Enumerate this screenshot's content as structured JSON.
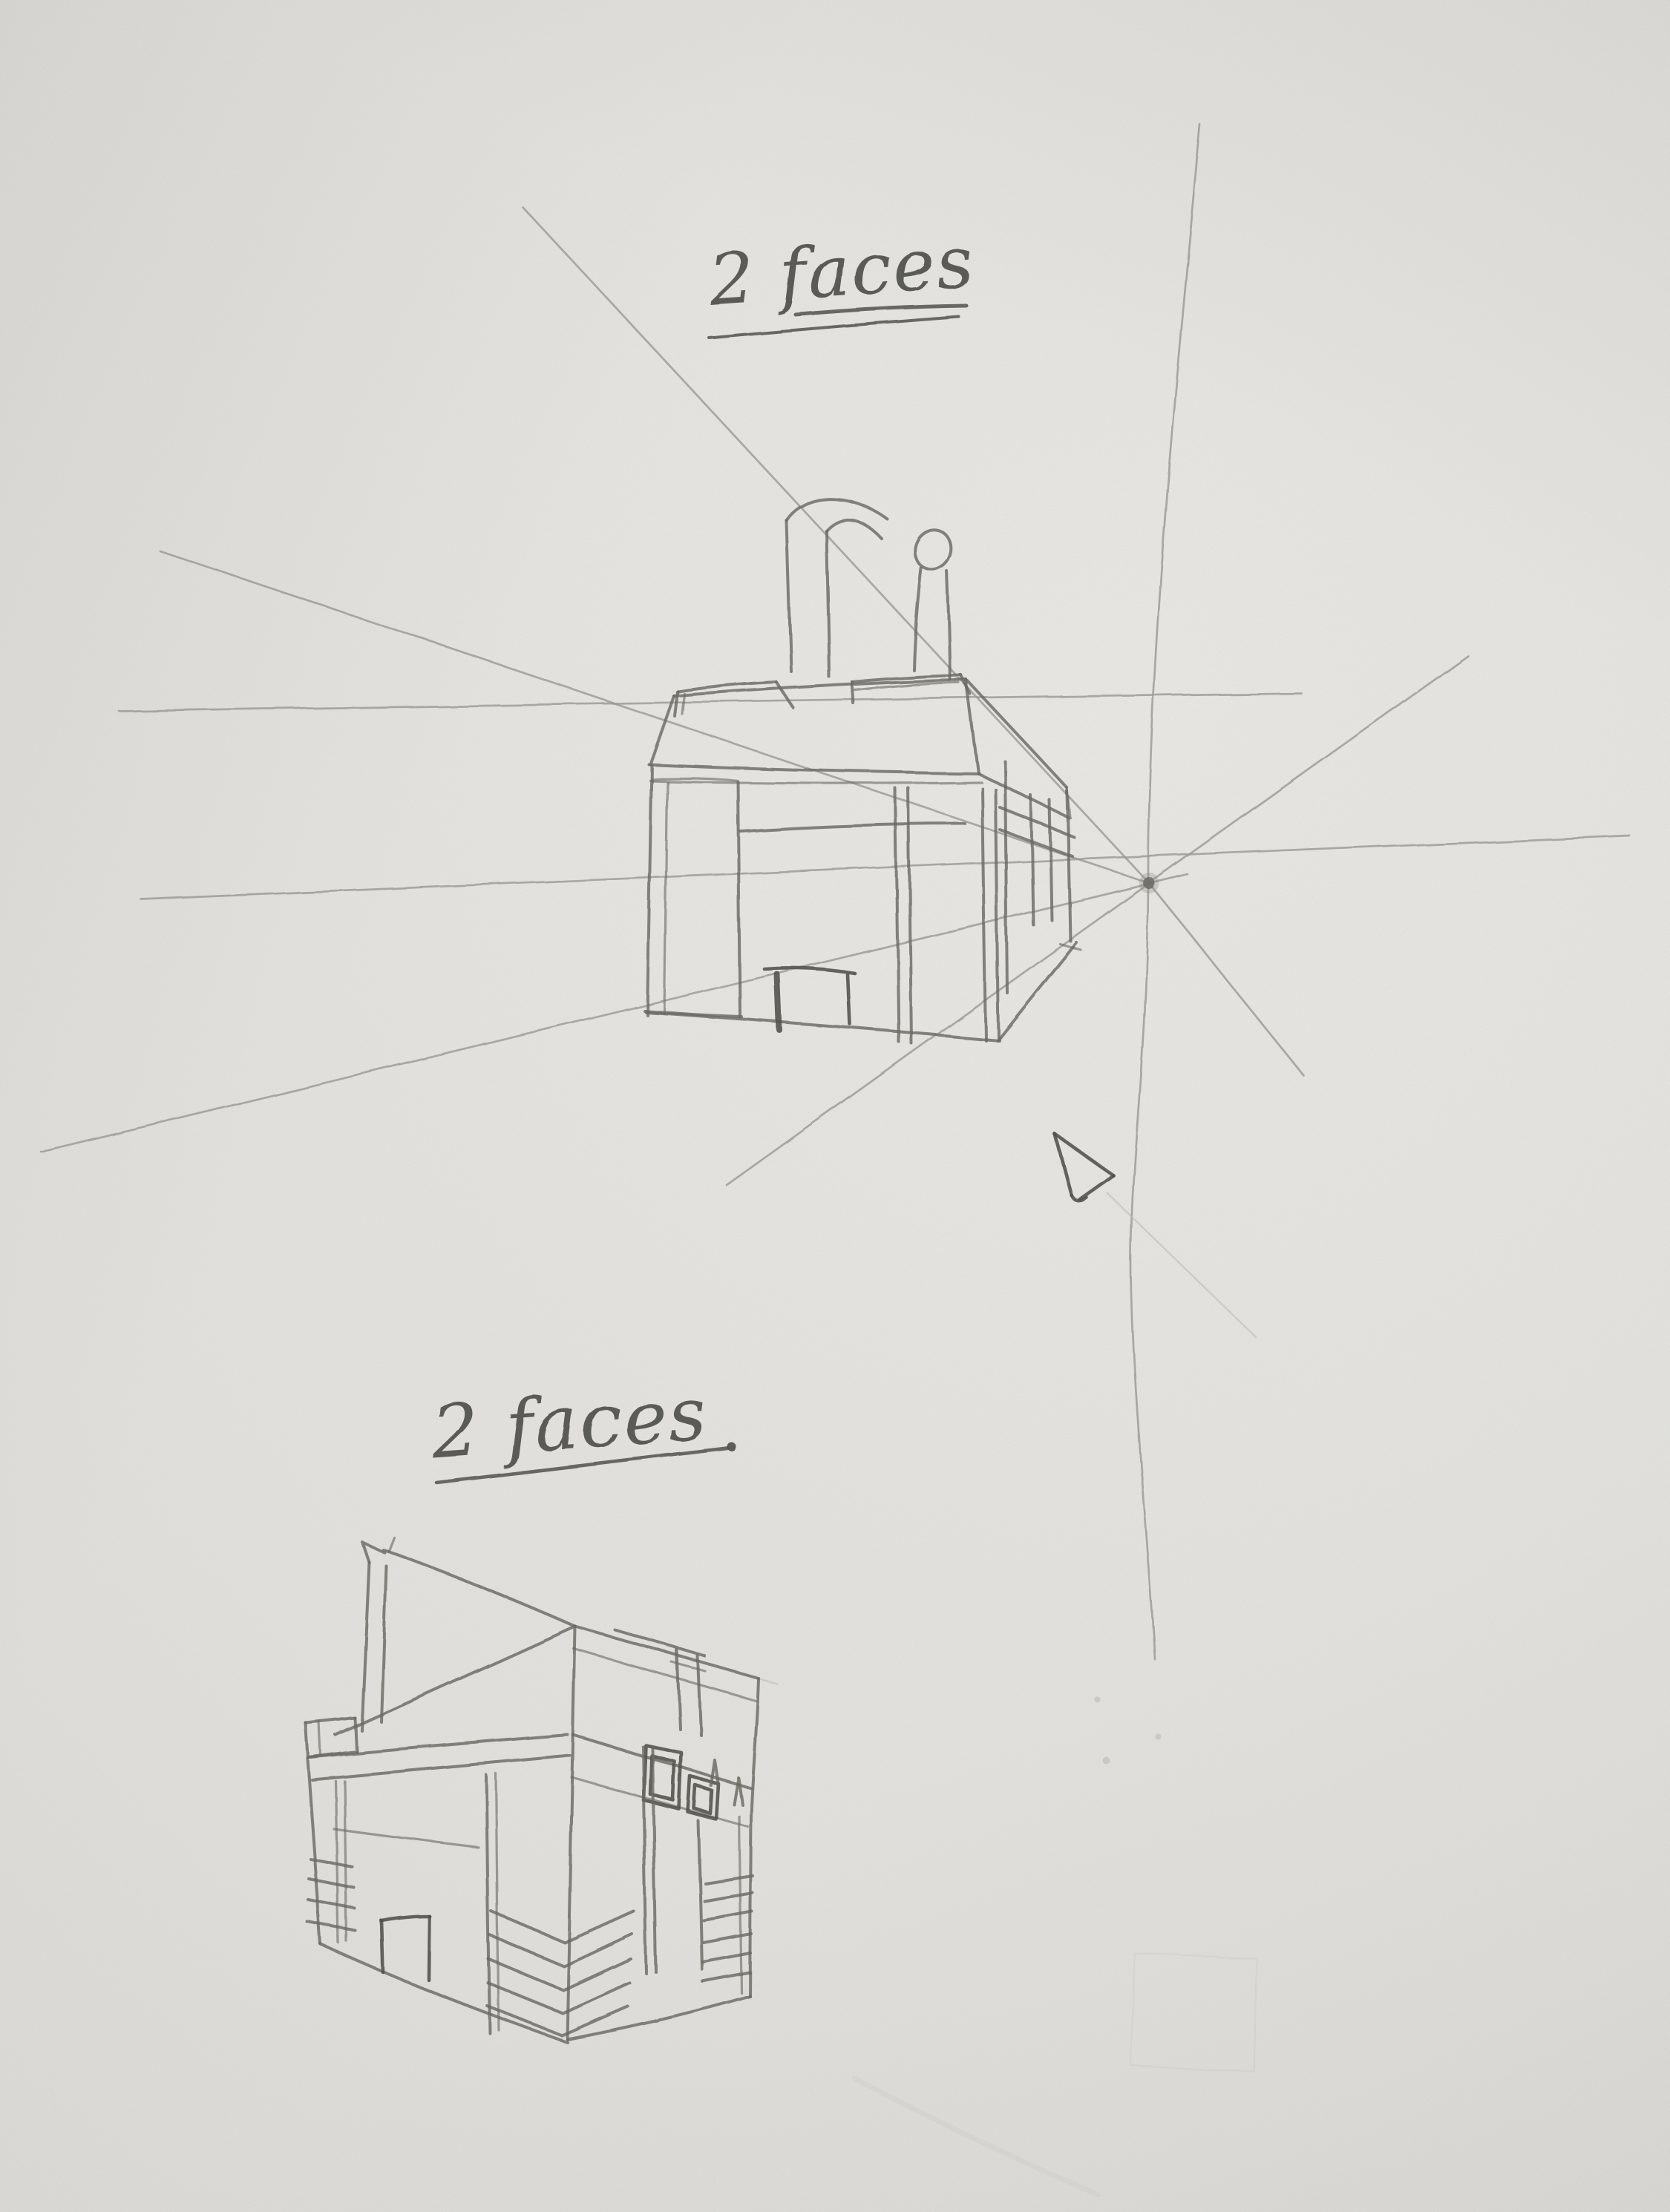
{
  "colors": {
    "paper": "#e8e7e3",
    "paper-light": "#efeeea",
    "paper-shade": "#d8d7d3",
    "pencil": "#6f6f69",
    "pencil-dark": "#54544e",
    "faint": "#9d9c97",
    "xfaint": "#c6c5c0",
    "ink": "#4d4d48"
  },
  "labels": {
    "top": {
      "text": "2 faces",
      "underlines": 2
    },
    "bottom": {
      "text": "2 faces",
      "underlines": 1
    }
  },
  "sketches": {
    "top": {
      "caption": "2 faces",
      "perspective": "one-point",
      "features": [
        "building front with pillars and openings",
        "rooftop chimney pipe with round outlet",
        "two low roof boxes",
        "small bench in central opening",
        "side railing slats receding right",
        "vanishing point dot",
        "radiating construction lines",
        "horizon guide line",
        "cursor-style arrow annotation with faint shaft"
      ]
    },
    "bottom": {
      "caption": "2 faces",
      "perspective": "two-point",
      "features": [
        "corner view building",
        "mast with pennant flag",
        "tilted triangular roof plane",
        "rooftop frame posts",
        "door opening",
        "two framed windows",
        "louver vent stacks at corners",
        "ladder lines at right edge"
      ]
    }
  }
}
